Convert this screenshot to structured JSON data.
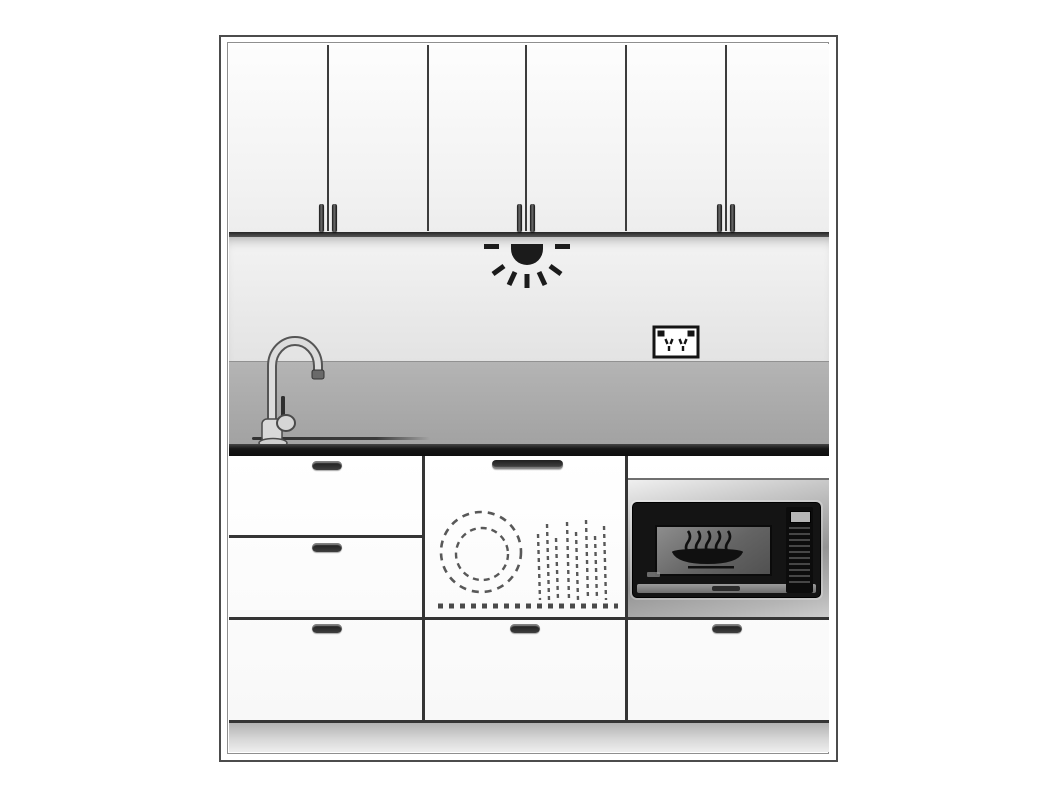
{
  "scene": {
    "type": "kitchen-elevation-line-drawing",
    "regions": [
      "wall-cabinets",
      "backsplash",
      "splashback-band",
      "countertop",
      "base-cabinets",
      "plinth"
    ],
    "appliances": [
      {
        "name": "under-cabinet-light",
        "symbol": "light-rays-icon"
      },
      {
        "name": "double-power-outlet",
        "symbol": "power-outlet-icon"
      },
      {
        "name": "gooseneck-faucet",
        "symbol": "faucet-profile"
      },
      {
        "name": "sink",
        "symbol": "sink-rim-line"
      },
      {
        "name": "integrated-dishwasher",
        "symbol": "dashed-plate-and-cutlery-icon"
      },
      {
        "name": "built-in-microwave",
        "symbol": "dish-with-steam-icon",
        "brand_text": ""
      }
    ]
  },
  "colors": {
    "frame_line": "#4c4c4c",
    "inner_line": "#8f8f8f",
    "divider_line": "#3c3c3c",
    "door_face": "#f6f6f6",
    "backsplash": "#ececec",
    "splash_band": "#aaaaaa",
    "countertop": "#161616",
    "plinth": "#c4c4c4",
    "stainless_trim": "#aeaeae",
    "microwave_body": "#141414",
    "dashed_symbol": "#585858"
  },
  "geometry": {
    "upper": {
      "door_count": 6,
      "divider_x": [
        328,
        428,
        526,
        626,
        726
      ],
      "handle_pairs_x": [
        328,
        526,
        726
      ],
      "handle": {
        "w": 5,
        "h": 28,
        "y": 204
      }
    },
    "lower": {
      "column_divider_x": [
        423,
        626
      ],
      "row_lines": [
        {
          "y": 536,
          "x1": 229,
          "x2": 423
        },
        {
          "y": 618,
          "x1": 229,
          "x2": 829
        },
        {
          "y": 721,
          "x1": 229,
          "x2": 829
        }
      ],
      "drawer_handles": [
        {
          "x": 312,
          "y": 461
        },
        {
          "x": 312,
          "y": 543
        },
        {
          "x": 312,
          "y": 624
        },
        {
          "x": 510,
          "y": 624
        },
        {
          "x": 712,
          "y": 624
        }
      ],
      "dishwasher_handle": {
        "x": 492,
        "y": 460,
        "w": 71,
        "h": 9
      }
    },
    "dishwasher_symbol": {
      "cutlery": [
        {
          "x": 110,
          "top": 38
        },
        {
          "x": 119,
          "top": 28
        },
        {
          "x": 128,
          "top": 42
        },
        {
          "x": 139,
          "top": 26
        },
        {
          "x": 148,
          "top": 36
        },
        {
          "x": 158,
          "top": 24
        },
        {
          "x": 167,
          "top": 40
        },
        {
          "x": 176,
          "top": 30
        }
      ]
    },
    "microwave": {
      "steam_x": [
        33,
        43,
        53,
        63,
        73
      ]
    }
  }
}
